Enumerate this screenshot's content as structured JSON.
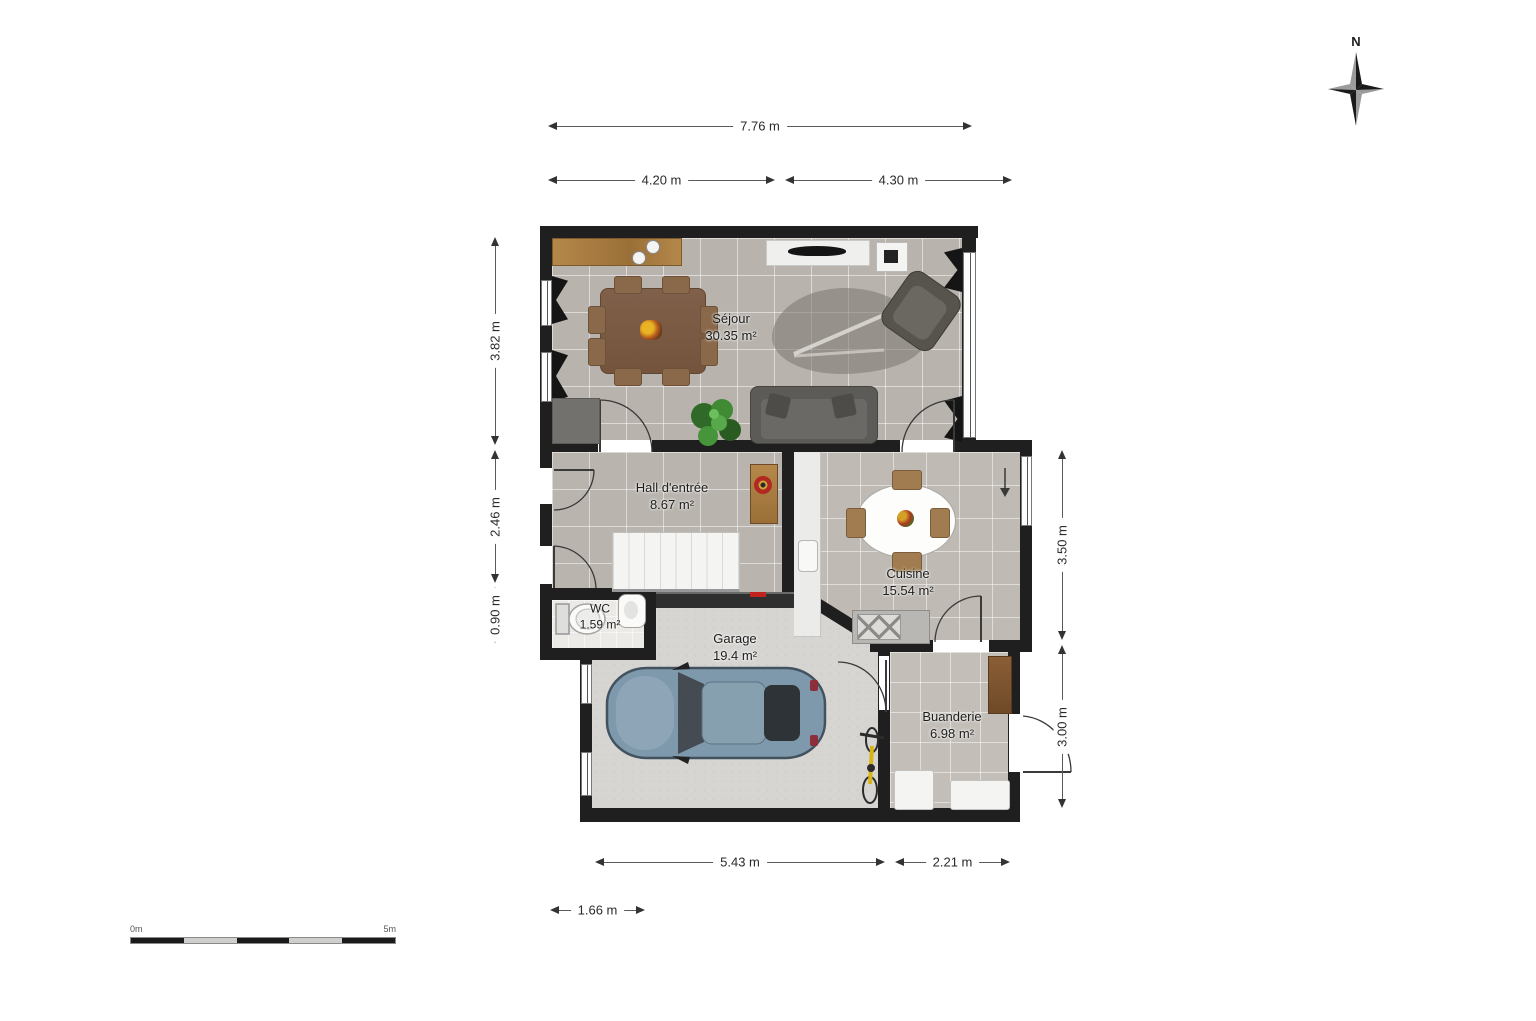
{
  "plan": {
    "compass": {
      "label": "N"
    },
    "scale_bar": {
      "start_label": "0m",
      "end_label": "5m"
    },
    "rooms": [
      {
        "name": "Séjour",
        "area": "30.35 m²"
      },
      {
        "name": "Hall d'entrée",
        "area": "8.67 m²"
      },
      {
        "name": "Cuisine",
        "area": "15.54 m²"
      },
      {
        "name": "WC",
        "area": "1.59 m²"
      },
      {
        "name": "Garage",
        "area": "19.4 m²"
      },
      {
        "name": "Buanderie",
        "area": "6.98 m²"
      }
    ],
    "dimensions": {
      "top": [
        "7.76 m",
        "4.20 m",
        "4.30 m"
      ],
      "left": [
        "3.82 m",
        "2.46 m",
        "0.90 m"
      ],
      "right": [
        "3.50 m",
        "3.00 m"
      ],
      "bottom": [
        "5.43 m",
        "2.21 m",
        "1.66 m"
      ]
    },
    "colors": {
      "wall": "#1f1f1f",
      "tile_floor": "#b8b3ad",
      "garage_floor": "#d6d5d2",
      "wood": "#b5874a",
      "car_body": "#7e99ac",
      "accent_red": "#c0231d",
      "bike_yellow": "#d8b514",
      "plant_green": "#3d7a33"
    }
  }
}
